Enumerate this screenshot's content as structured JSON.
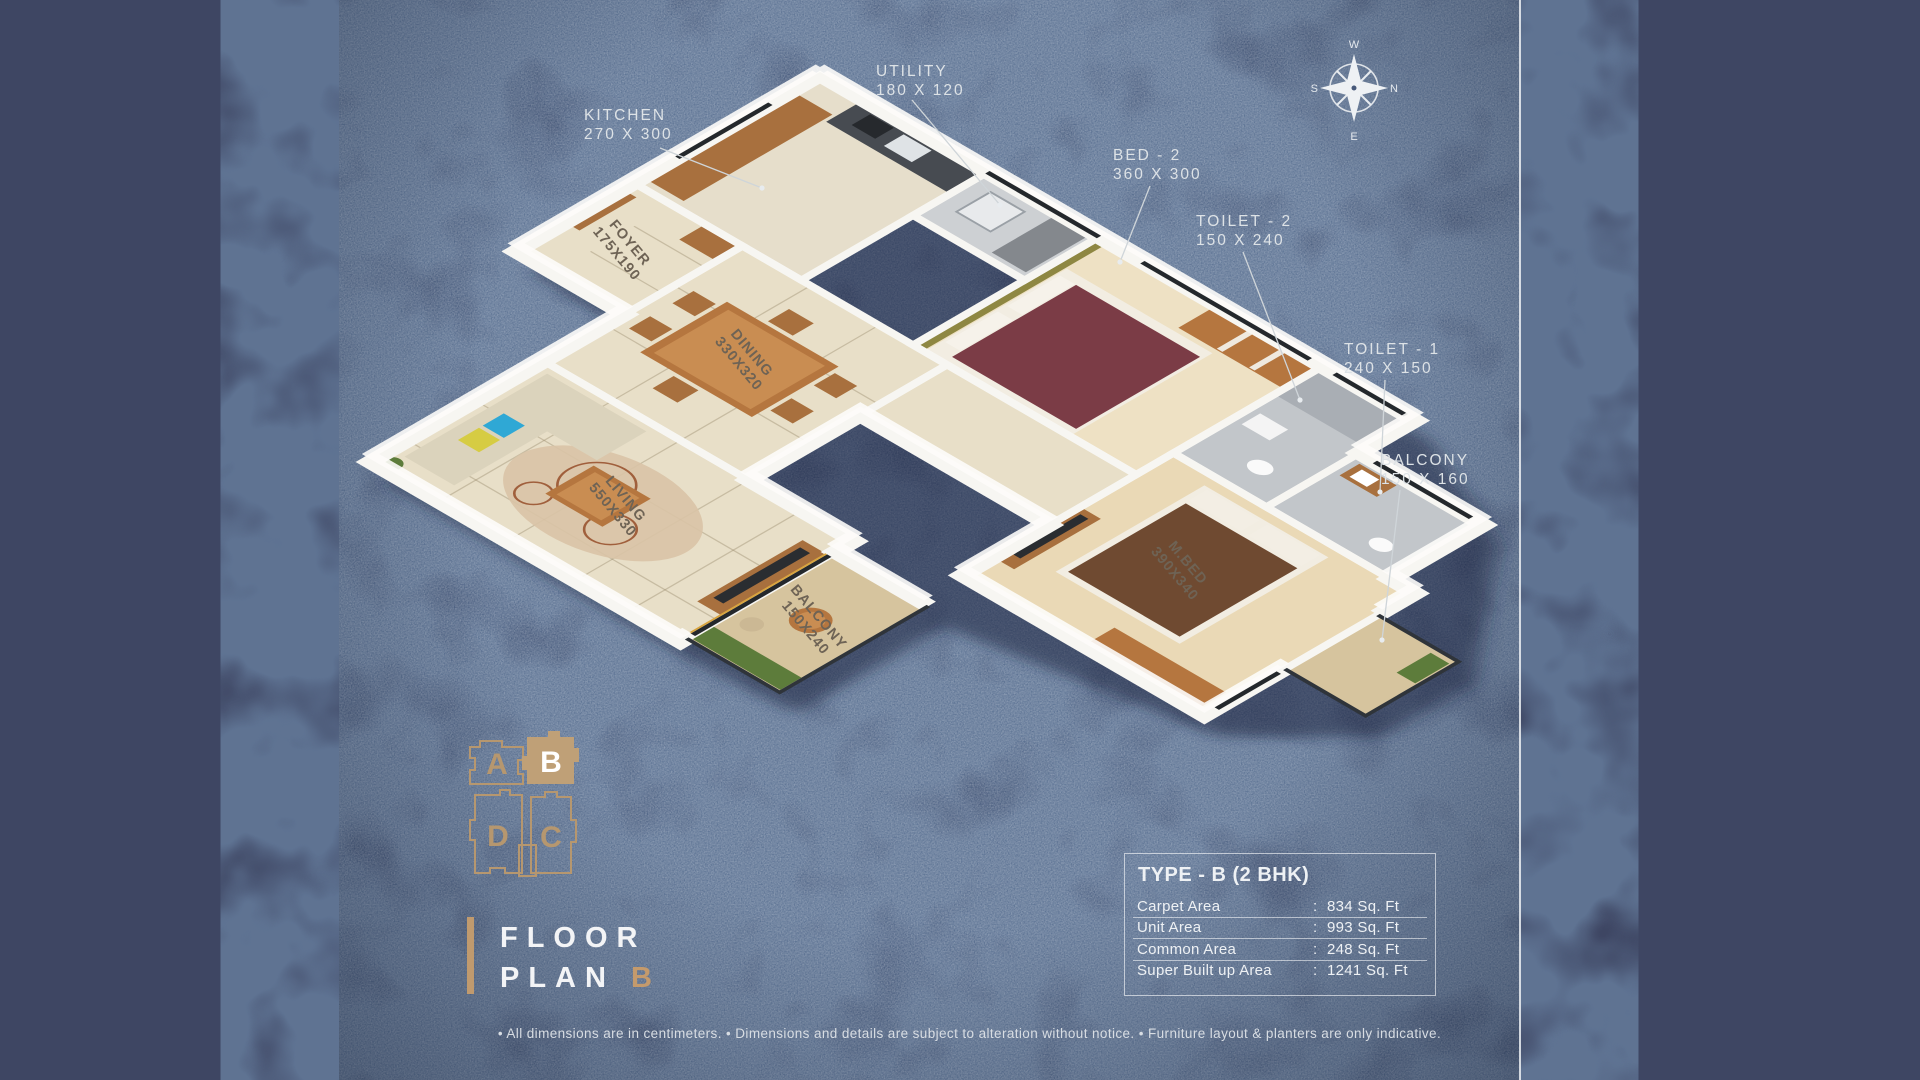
{
  "rooms": {
    "kitchen": {
      "name": "KITCHEN",
      "dims": "270 X 300"
    },
    "utility": {
      "name": "UTILITY",
      "dims": "180 X 120"
    },
    "bed2": {
      "name": "BED - 2",
      "dims": "360 X 300"
    },
    "toilet2": {
      "name": "TOILET - 2",
      "dims": "150 X 240"
    },
    "toilet1": {
      "name": "TOILET - 1",
      "dims": "240 X 150"
    },
    "balcony1": {
      "name": "BALCONY",
      "dims": "150 X 160"
    },
    "foyer": {
      "name": "FOYER",
      "dims": "175X190"
    },
    "dining": {
      "name": "DINING",
      "dims": "330X320"
    },
    "living": {
      "name": "LIVING",
      "dims": "550X330"
    },
    "mbed": {
      "name": "M.BED",
      "dims": "390X340"
    },
    "balcony2": {
      "name": "BALCONY",
      "dims": "150X240"
    }
  },
  "compass": {
    "top": "W",
    "right": "N",
    "bottom": "E",
    "left": "S"
  },
  "keyplan": {
    "a": "A",
    "b": "B",
    "c": "C",
    "d": "D",
    "highlighted": "B"
  },
  "title": {
    "line1": "FLOOR",
    "line2": "PLAN",
    "unit": "B"
  },
  "info_table": {
    "title": "TYPE - B (2 BHK)",
    "colon": ":",
    "rows": [
      {
        "label": "Carpet Area",
        "value": "834 Sq. Ft"
      },
      {
        "label": "Unit Area",
        "value": "993 Sq. Ft"
      },
      {
        "label": "Common Area",
        "value": "248 Sq. Ft"
      },
      {
        "label": "Super Built up Area",
        "value": "1241 Sq. Ft"
      }
    ]
  },
  "disclaimer": "• All dimensions are in centimeters. • Dimensions and details are subject to alteration without notice. • Furniture layout & planters are only indicative.",
  "colors": {
    "accent_tan": "#c09a6e",
    "panel_blue": "#47597a",
    "side_navy": "#3e4663",
    "wall_white": "#f7f6f2"
  }
}
